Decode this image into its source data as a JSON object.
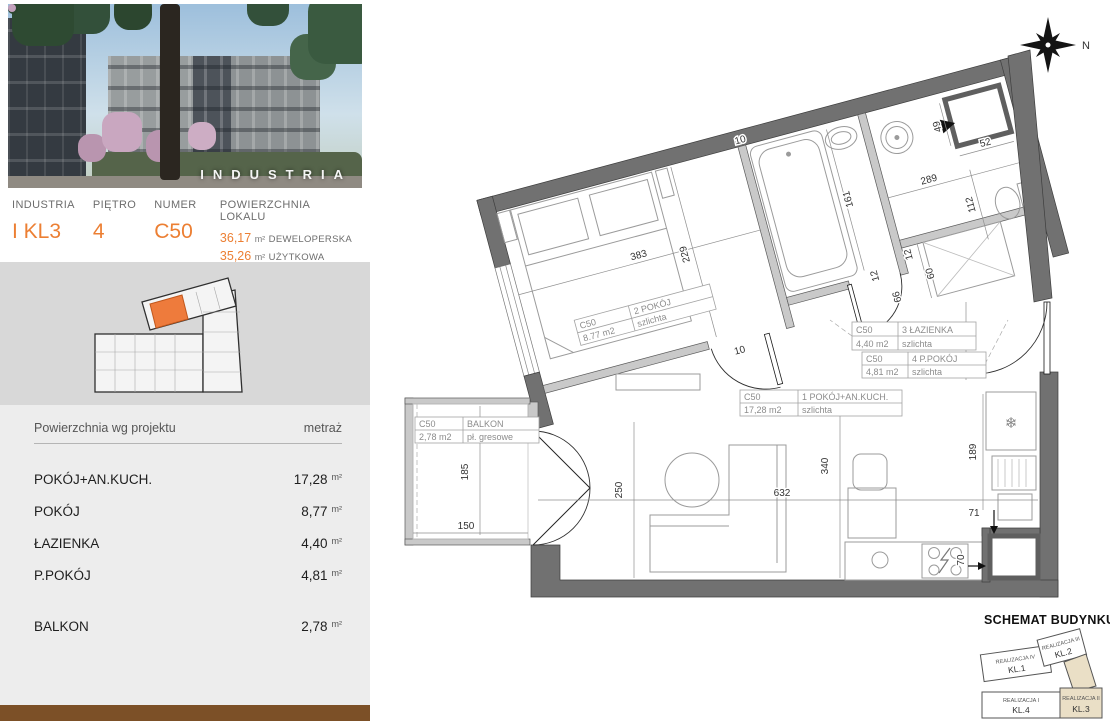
{
  "accent_color": "#ec7f33",
  "photo": {
    "wordmark": "INDUSTRIA"
  },
  "header": {
    "building": {
      "label": "INDUSTRIA",
      "value": "I KL3"
    },
    "floor": {
      "label": "PIĘTRO",
      "value": "4"
    },
    "number": {
      "label": "NUMER",
      "value": "C50"
    },
    "area": {
      "label": "POWIERZCHNIA LOKALU",
      "developer": {
        "value": "36,17",
        "unit": "m²",
        "kind": "DEWELOPERSKA"
      },
      "usable": {
        "value": "35,26",
        "unit": "m²",
        "kind": "UŻYTKOWA"
      }
    }
  },
  "area_table": {
    "col_left": "Powierzchnia wg projektu",
    "col_right": "metraż",
    "rows": [
      {
        "name": "POKÓJ+AN.KUCH.",
        "value": "17,28",
        "unit": "m²"
      },
      {
        "name": "POKÓJ",
        "value": "8,77",
        "unit": "m²"
      },
      {
        "name": "ŁAZIENKA",
        "value": "4,40",
        "unit": "m²"
      },
      {
        "name": "P.POKÓJ",
        "value": "4,81",
        "unit": "m²"
      },
      {
        "name": "BALKON",
        "value": "2,78",
        "unit": "m²"
      }
    ]
  },
  "plan": {
    "compass": "N",
    "icons": {
      "fridge_snowflake": "❄"
    },
    "room_labels": [
      {
        "unit": "C50",
        "name": "2 POKÓJ",
        "area": "8.77 m2",
        "floor": "szlichta"
      },
      {
        "unit": "C50",
        "name": "3 ŁAZIENKA",
        "area": "4,40 m2",
        "floor": "szlichta"
      },
      {
        "unit": "C50",
        "name": "4 P.POKÓJ",
        "area": "4,81 m2",
        "floor": "szlichta"
      },
      {
        "unit": "C50",
        "name": "1 POKÓJ+AN.KUCH.",
        "area": "17,28 m2",
        "floor": "szlichta"
      },
      {
        "unit": "C50",
        "name": "BALKON",
        "area": "2,78 m2",
        "floor": "pł. gresowe"
      }
    ],
    "dims": {
      "bedroom_width": "383",
      "bedroom_height": "229",
      "door_wall": "10",
      "top_wall": "10",
      "bath_length": "161",
      "upper_width": "289",
      "shaft_left": "49",
      "shaft_bottom": "52",
      "wc_width": "112",
      "wardrobe_wall": "12",
      "wardrobe_depth": "60",
      "hall_wall": "12",
      "hall_width": "66",
      "entry_clear": "166",
      "balcony_height": "185",
      "balcony_width": "150",
      "living_left": "250",
      "living_width": "632",
      "living_height": "340",
      "kitchen_height": "189",
      "kitchen_offset": "71",
      "kitchen_side": "70"
    }
  },
  "schematic": {
    "title": "SCHEMAT BUDYNKU",
    "segments": [
      {
        "name": "REALIZACJA IV",
        "kl": "KL.1"
      },
      {
        "name": "REALIZACJA III",
        "kl": "KL.2"
      },
      {
        "name": "REALIZACJA I",
        "kl": "KL.4"
      },
      {
        "name": "REALIZACJA II",
        "kl": "KL.3"
      }
    ]
  }
}
